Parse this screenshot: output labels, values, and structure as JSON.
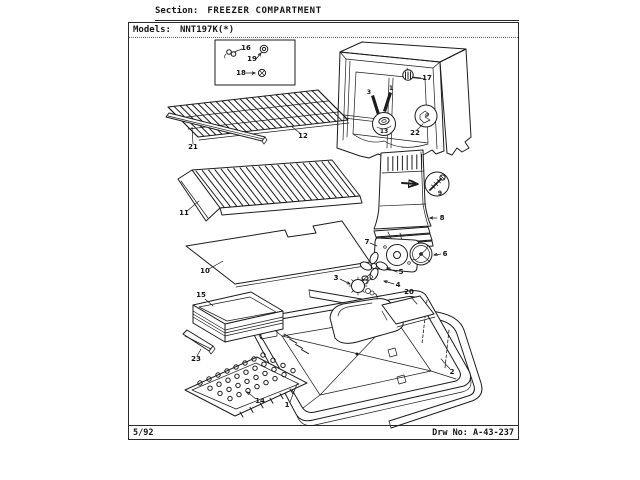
{
  "header": {
    "section_label": "Section:",
    "section_title": "FREEZER COMPARTMENT",
    "models_label": "Models:",
    "models_value": "NNT197K(*)"
  },
  "footer": {
    "revision_date": "5/92",
    "drawing_label": "Drw No:",
    "drawing_number": "A-43-237"
  },
  "colors": {
    "ink": "#1c1c1c",
    "paper": "#ffffff"
  },
  "callouts": {
    "c1a": "1",
    "c1b": "1",
    "c2": "2",
    "c3a": "3",
    "c3b": "3",
    "c4": "4",
    "c5": "5",
    "c6": "6",
    "c7": "7",
    "c8": "8",
    "c9": "9",
    "c10": "10",
    "c11": "11",
    "c12": "12",
    "c13": "13",
    "c14": "14",
    "c15": "15",
    "c16": "16",
    "c17": "17",
    "c18": "18",
    "c19": "19",
    "c20": "20",
    "c21": "21",
    "c22": "22",
    "c23": "23"
  }
}
